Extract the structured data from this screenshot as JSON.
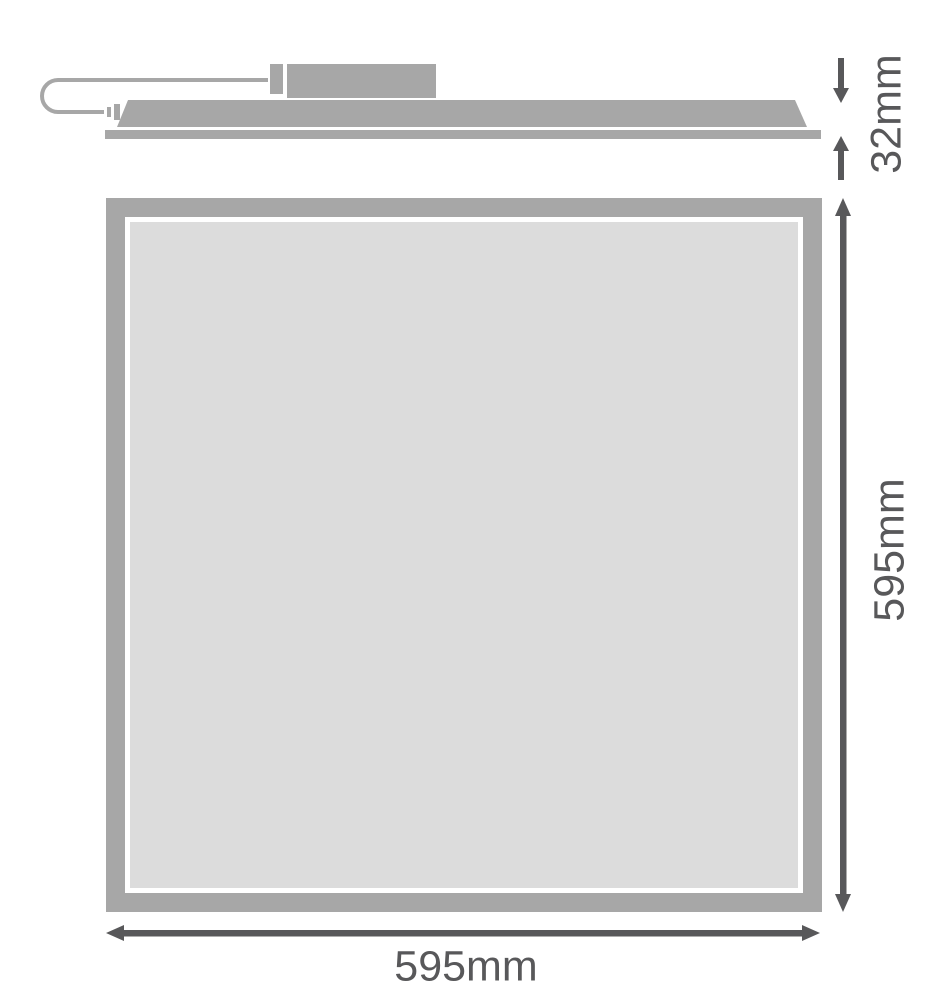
{
  "diagram": {
    "kind": "product-dimension-drawing",
    "side_view": {
      "parts": [
        "power-cable",
        "cable-plug",
        "driver-box",
        "panel-profile",
        "frame-flange"
      ],
      "thickness_dimension": {
        "label": "32mm",
        "value_mm": 32
      }
    },
    "front_view": {
      "height_dimension": {
        "label": "595mm",
        "value_mm": 595
      },
      "width_dimension": {
        "label": "595mm",
        "value_mm": 595
      }
    },
    "colors": {
      "outline_gray": "#a7a7a7",
      "panel_face_gray": "#dcdcdc",
      "dimension_dark": "#58585a",
      "background": "#ffffff",
      "gap_white": "#ffffff"
    }
  }
}
